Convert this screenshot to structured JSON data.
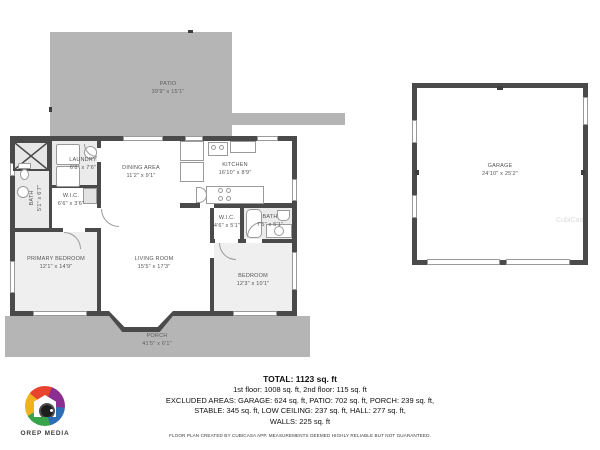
{
  "plan": {
    "rooms": {
      "patio": {
        "name": "PATIO",
        "dims": "39'9\" x 15'1\""
      },
      "laundry": {
        "name": "LAUNDRY",
        "dims": "6'8\" x 7'6\""
      },
      "bath_left": {
        "name": "BATH",
        "dims": "5'1\" x 6'7\""
      },
      "wic_left": {
        "name": "W.I.C.",
        "dims": "6'6\" x 3'6\""
      },
      "dining": {
        "name": "DINING AREA",
        "dims": "11'2\" x 9'1\""
      },
      "kitchen": {
        "name": "KITCHEN",
        "dims": "16'10\" x 8'9\""
      },
      "primary_bedroom": {
        "name": "PRIMARY BEDROOM",
        "dims": "12'1\" x 14'9\""
      },
      "living": {
        "name": "LIVING ROOM",
        "dims": "15'5\" x 17'3\""
      },
      "wic_right": {
        "name": "W.I.C.",
        "dims": "4'6\" x 5'1\""
      },
      "bath_right": {
        "name": "BATH",
        "dims": "7'5\" x 5'1\""
      },
      "bedroom": {
        "name": "BEDROOM",
        "dims": "12'3\" x 10'1\""
      },
      "porch": {
        "name": "PORCH",
        "dims": "41'5\" x 6'1\""
      },
      "garage": {
        "name": "GARAGE",
        "dims": "24'10\" x 25'2\""
      }
    },
    "watermark": "CubiCasa"
  },
  "summary": {
    "total": "TOTAL: 1123 sq. ft",
    "floors": "1st floor: 1008 sq. ft, 2nd floor: 115 sq. ft",
    "excluded1": "EXCLUDED AREAS: GARAGE: 624 sq. ft, PATIO: 702 sq. ft, PORCH: 239 sq. ft,",
    "excluded2": "STABLE: 345 sq. ft, LOW CEILING: 237 sq. ft, HALL: 277 sq. ft,",
    "excluded3": "WALLS: 225 sq. ft",
    "disclaimer": "FLOOR PLAN CREATED BY CUBICASA APP. MEASUREMENTS DEEMED HIGHLY RELIABLE BUT NOT GUARANTEED."
  },
  "branding": {
    "name": "OREP MEDIA"
  },
  "colors": {
    "wall": "#4a4a4a",
    "patio": "#b5b5b5",
    "room_tint": "#ebebeb",
    "label": "#555555",
    "logo_palette": [
      "#e8432d",
      "#8a2f90",
      "#2d6db5",
      "#37a34a",
      "#f0b31c"
    ]
  }
}
